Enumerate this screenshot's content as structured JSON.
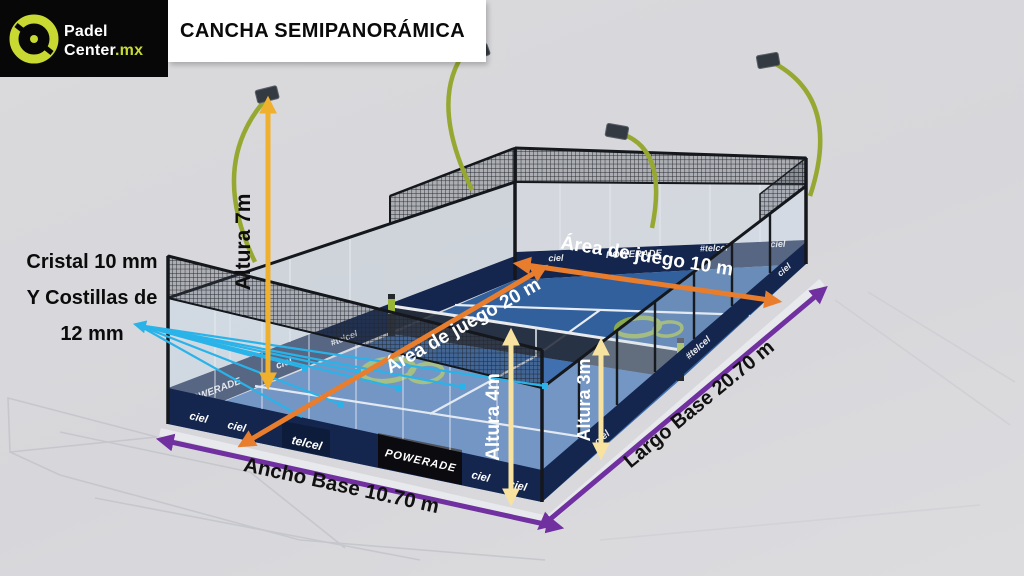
{
  "header": {
    "brand": {
      "line1": "Padel",
      "line2": "Center",
      "tld": ".mx"
    },
    "title": "CANCHA SEMIPANORÁMICA"
  },
  "note": {
    "line1": "Cristal 10 mm",
    "line2": "Y Costillas de",
    "line3": "12 mm"
  },
  "dimensions": {
    "pole_height": "Altura 7m",
    "wall_height_end": "Altura 4m",
    "wall_height_side": "Altura 3m",
    "play_width": "Área de juego 10 m",
    "play_length": "Área de juego 20 m",
    "base_length": "Largo Base 20.70 m",
    "base_width": "Ancho Base 10.70 m"
  },
  "sponsors": {
    "powerade": "POWERADE",
    "telcel": "telcel",
    "telcel_tag": "#telcel",
    "ciel": "ciel"
  },
  "colors": {
    "accent_lime": "#c8da32",
    "arrow_yellow": "#efb02e",
    "arrow_pale_yellow": "#f8e2a0",
    "arrow_orange": "#e87d2d",
    "arrow_purple": "#7030a0",
    "pointer_cyan": "#2ab3e8",
    "court_blue": "#3f6fae",
    "band_navy": "#14264d"
  }
}
